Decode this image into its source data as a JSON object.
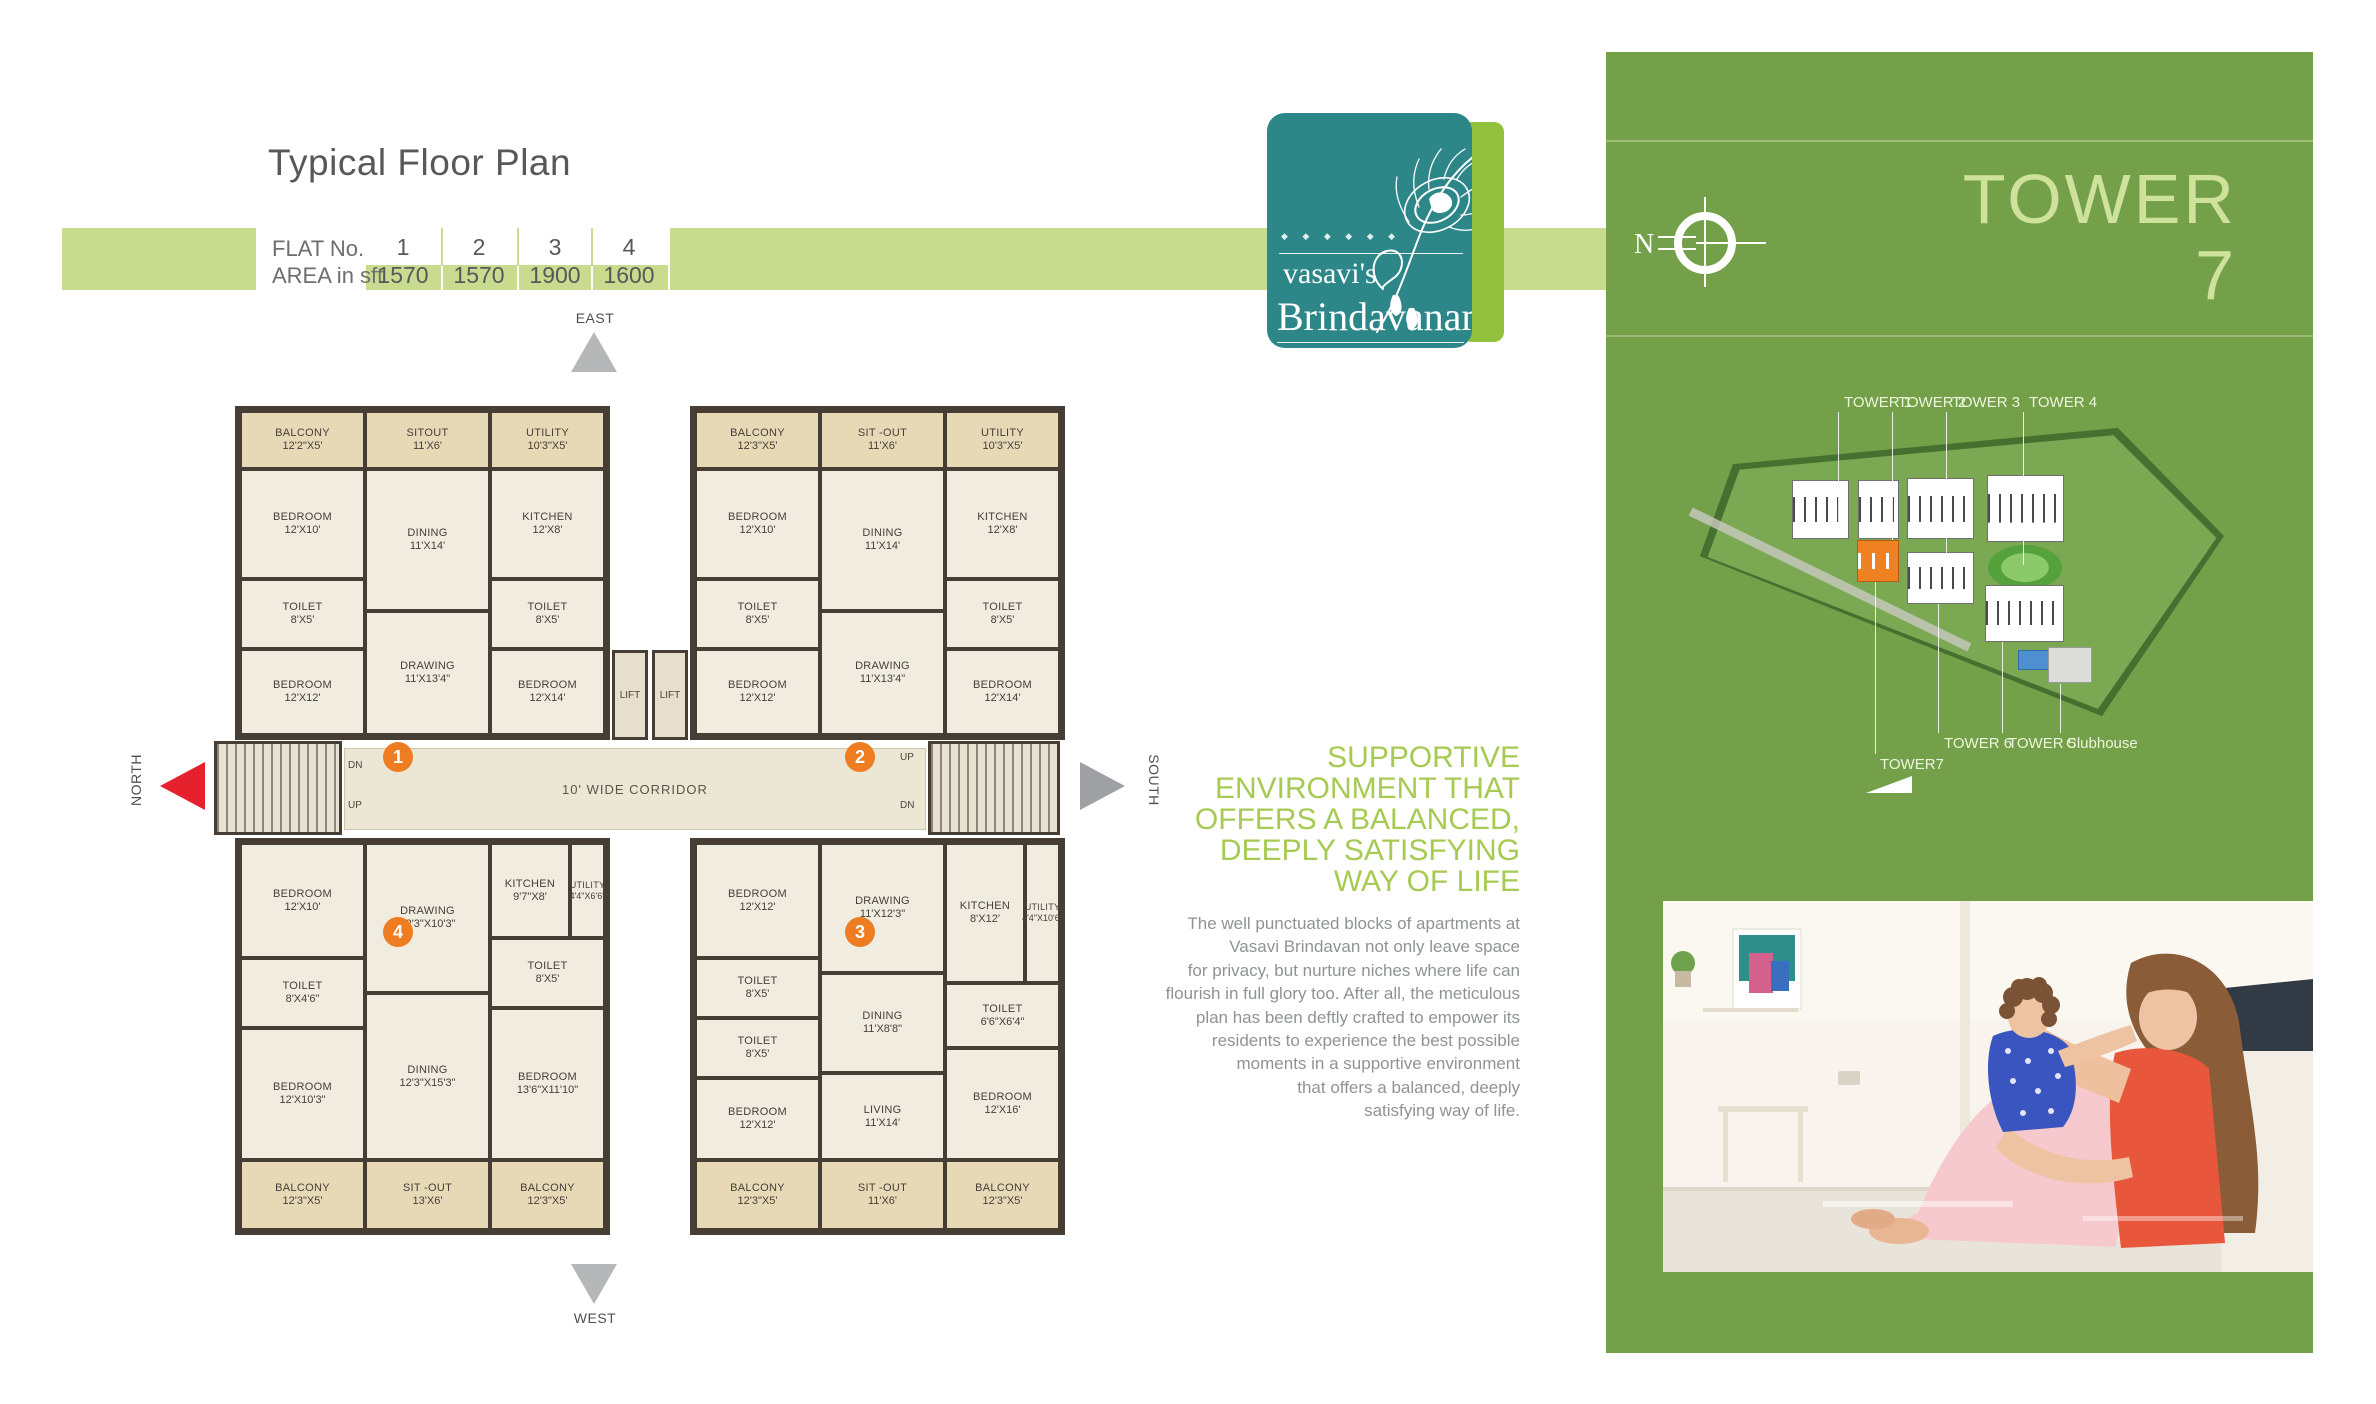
{
  "page": {
    "title": "Typical Floor Plan"
  },
  "flat_table": {
    "row1_label": "FLAT No.",
    "row2_label": "AREA in sft",
    "flats": [
      {
        "no": "1",
        "area": "1570"
      },
      {
        "no": "2",
        "area": "1570"
      },
      {
        "no": "3",
        "area": "1900"
      },
      {
        "no": "4",
        "area": "1600"
      }
    ]
  },
  "floor_plan": {
    "directions": {
      "east": "EAST",
      "west": "WEST",
      "north": "NORTH",
      "south": "SOUTH"
    },
    "corridor_label": "10' WIDE CORRIDOR",
    "lift_label_1": "LIFT",
    "lift_label_2": "LIFT",
    "stairs": {
      "left_dn": "DN",
      "left_up": "UP",
      "right_up": "UP",
      "right_dn": "DN"
    },
    "unit_markers": [
      "1",
      "2",
      "3",
      "4"
    ],
    "flat1": {
      "balcony": {
        "name": "BALCONY",
        "dims": "12'2\"X5'"
      },
      "sitout": {
        "name": "SITOUT",
        "dims": "11'X6'"
      },
      "utility": {
        "name": "UTILITY",
        "dims": "10'3\"X5'"
      },
      "bedroom1": {
        "name": "BEDROOM",
        "dims": "12'X10'"
      },
      "dining": {
        "name": "DINING",
        "dims": "11'X14'"
      },
      "kitchen": {
        "name": "KITCHEN",
        "dims": "12'X8'"
      },
      "toilet1": {
        "name": "TOILET",
        "dims": "8'X5'"
      },
      "toilet2": {
        "name": "TOILET",
        "dims": "8'X5'"
      },
      "bedroom2": {
        "name": "BEDROOM",
        "dims": "12'X12'"
      },
      "drawing": {
        "name": "DRAWING",
        "dims": "11'X13'4\""
      },
      "bedroom3": {
        "name": "BEDROOM",
        "dims": "12'X14'"
      }
    },
    "flat2": {
      "balcony": {
        "name": "BALCONY",
        "dims": "12'3\"X5'"
      },
      "sitout": {
        "name": "SIT -OUT",
        "dims": "11'X6'"
      },
      "utility": {
        "name": "UTILITY",
        "dims": "10'3\"X5'"
      },
      "bedroom1": {
        "name": "BEDROOM",
        "dims": "12'X10'"
      },
      "dining": {
        "name": "DINING",
        "dims": "11'X14'"
      },
      "kitchen": {
        "name": "KITCHEN",
        "dims": "12'X8'"
      },
      "toilet1": {
        "name": "TOILET",
        "dims": "8'X5'"
      },
      "toilet2": {
        "name": "TOILET",
        "dims": "8'X5'"
      },
      "bedroom2": {
        "name": "BEDROOM",
        "dims": "12'X12'"
      },
      "drawing": {
        "name": "DRAWING",
        "dims": "11'X13'4\""
      },
      "bedroom3": {
        "name": "BEDROOM",
        "dims": "12'X14'"
      }
    },
    "flat4": {
      "bedroom1": {
        "name": "BEDROOM",
        "dims": "12'X10'"
      },
      "drawing": {
        "name": "DRAWING",
        "dims": "12'3\"X10'3\""
      },
      "kitchen": {
        "name": "KITCHEN",
        "dims": "9'7\"X8'"
      },
      "utility": {
        "name": "UTILITY",
        "dims": "4'4\"X6'6\""
      },
      "toilet1": {
        "name": "TOILET",
        "dims": "8'X4'6\""
      },
      "dining": {
        "name": "DINING",
        "dims": "12'3\"X15'3\""
      },
      "toilet2": {
        "name": "TOILET",
        "dims": "8'X5'"
      },
      "bedroom2": {
        "name": "BEDROOM",
        "dims": "12'X10'3\""
      },
      "bedroom3": {
        "name": "BEDROOM",
        "dims": "13'6\"X11'10\""
      },
      "balcony1": {
        "name": "BALCONY",
        "dims": "12'3\"X5'"
      },
      "sitout": {
        "name": "SIT -OUT",
        "dims": "13'X6'"
      },
      "balcony2": {
        "name": "BALCONY",
        "dims": "12'3\"X5'"
      }
    },
    "flat3": {
      "bedroom1": {
        "name": "BEDROOM",
        "dims": "12'X12'"
      },
      "drawing": {
        "name": "DRAWING",
        "dims": "11'X12'3\""
      },
      "kitchen": {
        "name": "KITCHEN",
        "dims": "8'X12'"
      },
      "utility": {
        "name": "UTILITY",
        "dims": "4'4\"X10'6\""
      },
      "toilet1": {
        "name": "TOILET",
        "dims": "8'X5'"
      },
      "toilet2": {
        "name": "TOILET",
        "dims": "6'6\"X6'4\""
      },
      "toilet3": {
        "name": "TOILET",
        "dims": "8'X5'"
      },
      "dining": {
        "name": "DINING",
        "dims": "11'X8'8\""
      },
      "living": {
        "name": "LIVING",
        "dims": "11'X14'"
      },
      "bedroom2": {
        "name": "BEDROOM",
        "dims": "12'X16'"
      },
      "bedroom3": {
        "name": "BEDROOM",
        "dims": "12'X12'"
      },
      "balcony1": {
        "name": "BALCONY",
        "dims": "12'3\"X5'"
      },
      "sitout": {
        "name": "SIT -OUT",
        "dims": "11'X6'"
      },
      "balcony2": {
        "name": "BALCONY",
        "dims": "12'3\"X5'"
      }
    }
  },
  "logo": {
    "brand_line1": "vasavi's",
    "brand_line2": "Brindavanam",
    "ornament": "◆ ◆ ◆ ◆ ◆ ◆"
  },
  "right_panel": {
    "title_line1": "TOWER",
    "title_line2": "7",
    "compass_letter": "N",
    "site_map": {
      "top_labels": [
        "TOWER 1",
        "TOWER 2",
        "TOWER 3",
        "TOWER 4"
      ],
      "bottom_labels": [
        "TOWER 6",
        "TOWER 5",
        "Clubhouse"
      ],
      "highlight_label": "TOWER7"
    },
    "headline_lines": [
      "SUPPORTIVE",
      "ENVIRONMENT THAT",
      "OFFERS A BALANCED,",
      "DEEPLY SATISFYING",
      "WAY OF LIFE"
    ],
    "body_lines": [
      "The well punctuated blocks of apartments at",
      "Vasavi Brindavan not only leave space",
      "for privacy, but nurture niches where life can",
      "flourish in full glory too. After all, the meticulous",
      "plan has been deftly crafted to empower its",
      "residents to experience the best possible",
      "moments in a supportive environment",
      "that offers a balanced, deeply",
      "satisfying way of life."
    ]
  },
  "colors": {
    "band_green": "#c9db8e",
    "panel_green": "#74a04a",
    "headline_green": "#a6ca52",
    "tower_text_green": "#cfe29b",
    "logo_teal": "#2d8688",
    "logo_strip_green": "#94c13d",
    "accent_orange": "#ee7d22",
    "north_red": "#e5212e",
    "arrow_gray": "#9ea0a3",
    "wall_dark": "#463e34",
    "floor_cream": "#f1ece0",
    "balcony_tan": "#e8d9b6"
  }
}
